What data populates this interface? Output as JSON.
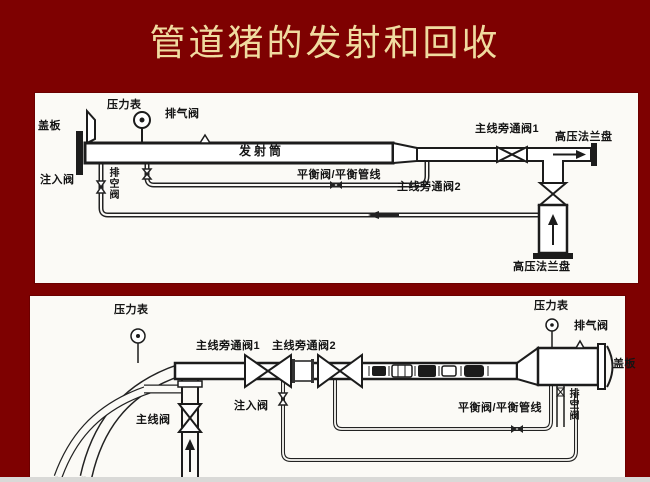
{
  "title": "管道猪的发射和回收",
  "colors": {
    "background": "#7E0101",
    "panel": "#FBFAF6",
    "ink": "#1c1c1c",
    "title_text": "#F0DBA0",
    "bottom_strip": "#D9D9D7"
  },
  "launcher_diagram": {
    "name": "pig-launcher",
    "labels": {
      "cover_plate": "盖板",
      "pressure_gauge": "压力表",
      "vent_valve": "排气阀",
      "launcher_barrel": "发射筒",
      "main_bypass_valve_1": "主线旁通阀1",
      "hp_flange_top": "高压法兰盘",
      "injection_valve": "注入阀",
      "drain_valve": "排空阀",
      "balance_valve_line": "平衡阀/平衡管线",
      "main_bypass_valve_2": "主线旁通阀2",
      "hp_flange_bottom": "高压法兰盘"
    }
  },
  "receiver_diagram": {
    "name": "pig-receiver",
    "labels": {
      "pressure_gauge_left": "压力表",
      "main_bypass_valve_1": "主线旁通阀1",
      "main_bypass_valve_2": "主线旁通阀2",
      "pressure_gauge_right": "压力表",
      "vent_valve": "排气阀",
      "cover_plate": "盖板",
      "main_line_valve": "主线阀",
      "injection_valve": "注入阀",
      "balance_valve_line": "平衡阀/平衡管线",
      "drain_valve": "排空阀"
    }
  }
}
